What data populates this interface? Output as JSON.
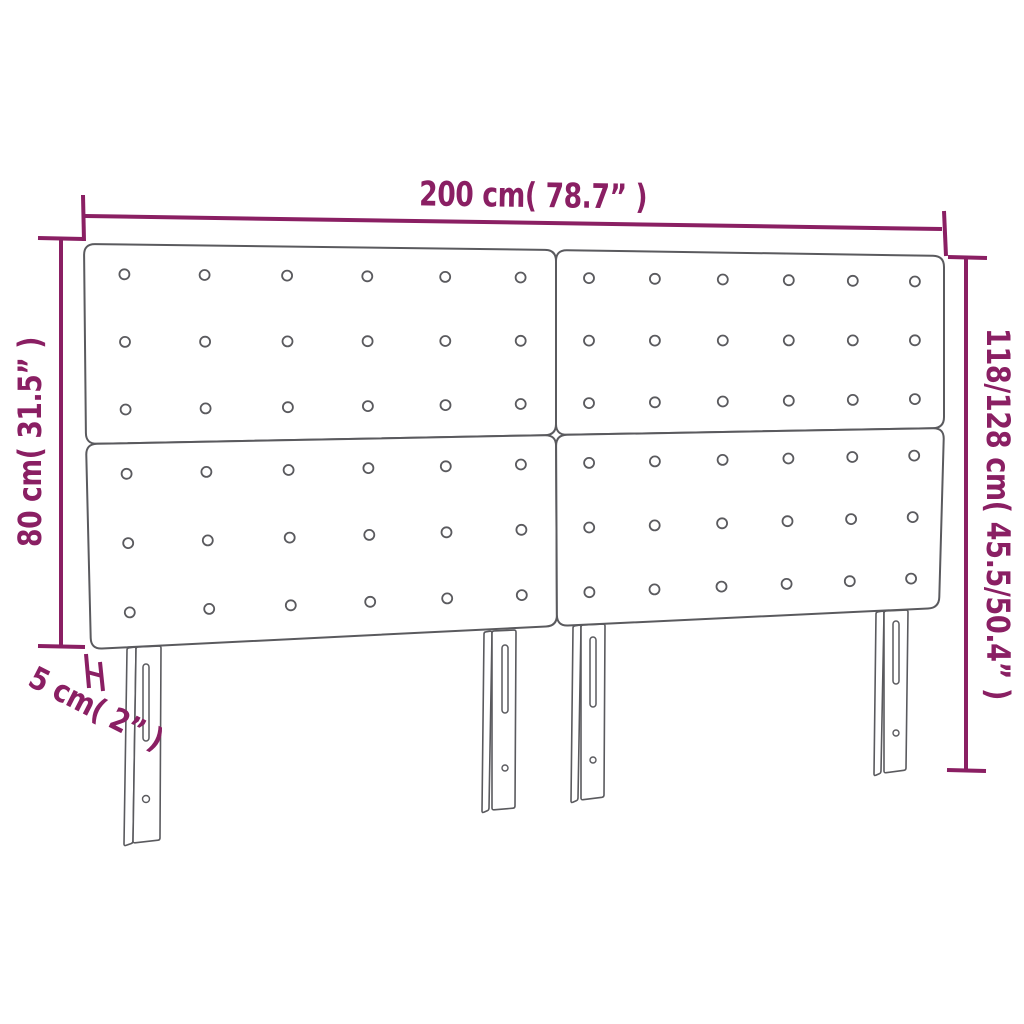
{
  "colors": {
    "accent": "#8a1f63",
    "outline": "#5a5a5e",
    "background": "#ffffff"
  },
  "dimensions": {
    "width": {
      "label": "200 cm( 78.7” )"
    },
    "total_height": {
      "label": "118/128 cm( 45.5/50.4” )"
    },
    "headboard_height": {
      "label": "80 cm( 31.5” )"
    },
    "depth": {
      "label": "5 cm( 2” )"
    }
  },
  "figure": {
    "panel_count": 4,
    "button_columns_per_panel": 6,
    "button_rows_per_panel": 3,
    "leg_count": 4
  }
}
